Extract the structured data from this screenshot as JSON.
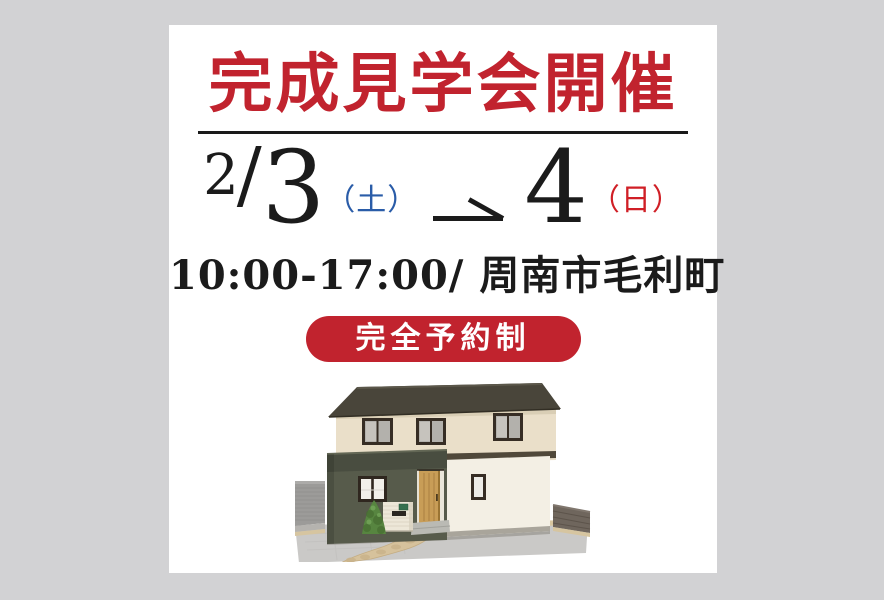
{
  "canvas": {
    "background_color": "#d2d2d4"
  },
  "card": {
    "background_color": "#ffffff"
  },
  "header": {
    "title": "完成見学会開催",
    "title_color": "#c1232e"
  },
  "dates": {
    "month": "2",
    "month_day_separator": "/",
    "start_day": "3",
    "start_weekday": "（土）",
    "start_weekday_color": "#2a5ca8",
    "arrow_icon": "rightwards-harpoon-arrow",
    "end_day": "4",
    "end_weekday": "（日）",
    "end_weekday_color": "#d01f26",
    "text_color": "#1b1b1b"
  },
  "details": {
    "hours_location": "10:00-17:00/ 周南市毛利町"
  },
  "badge": {
    "label": "完全予約制",
    "background_color": "#c1232e",
    "text_color": "#ffffff"
  },
  "illustration": {
    "name": "two-story-house-3d-render"
  }
}
